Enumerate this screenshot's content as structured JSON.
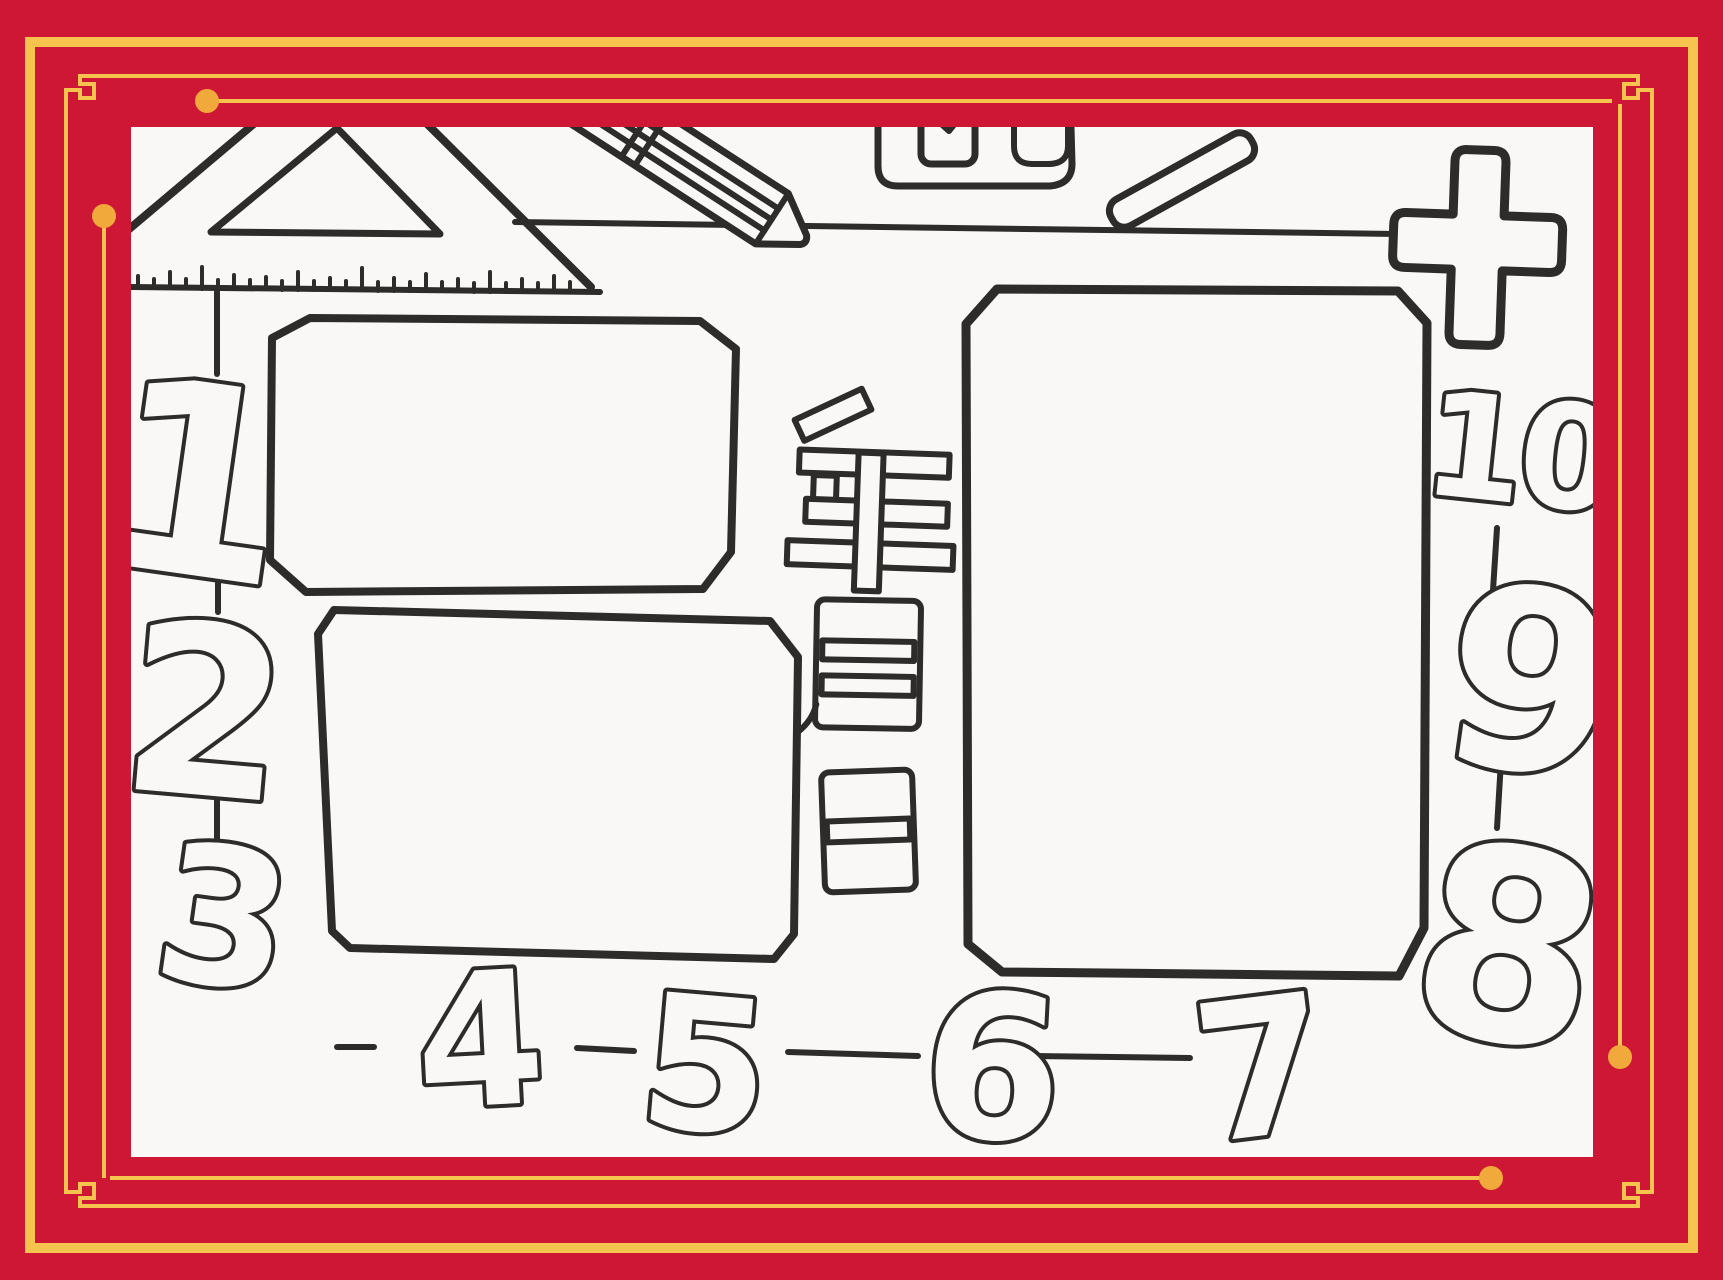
{
  "colors": {
    "frame_red": "#ce1735",
    "border_gold": "#f6c44e",
    "dot_gold": "#f2a93b",
    "paper_white": "#faf8f7",
    "ink_black": "#2d2c2a"
  },
  "date_label": {
    "year_char": "年",
    "month_char": "月",
    "day_char": "日"
  },
  "numbers": {
    "left": [
      "1",
      "2",
      "3"
    ],
    "bottom": [
      "4",
      "5",
      "6",
      "7"
    ],
    "right": [
      "8",
      "9",
      "10"
    ],
    "plus_sign": "+"
  },
  "decorations": {
    "items": [
      "set-square-icon",
      "ruler-ticks",
      "pencil-icon",
      "sharpener-icon",
      "chalk-icon",
      "plus-sign-icon"
    ]
  },
  "content_boxes": {
    "count": 3,
    "description": "empty hand-drawn writing frames"
  }
}
